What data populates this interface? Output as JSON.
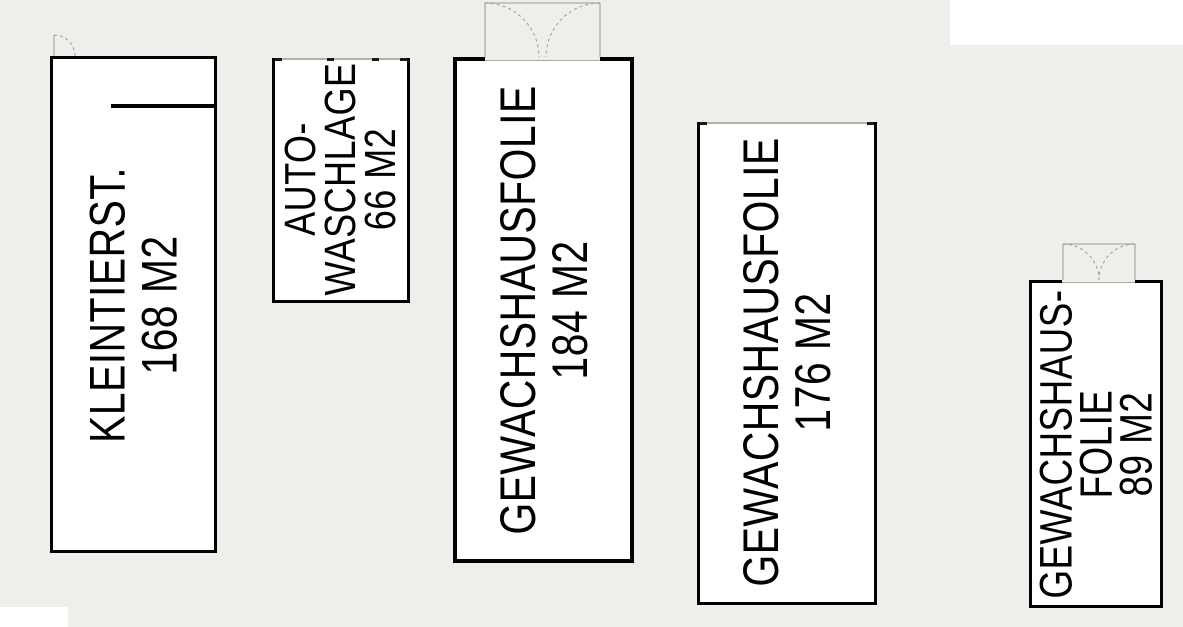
{
  "page": {
    "background_color": "#efeeea",
    "paper_color": "#ffffff",
    "wall_color": "#000000",
    "door_symbol_color": "#9b9a92"
  },
  "icons": {
    "single_door": "door-swing-icon",
    "double_door": "double-door-swing-icon"
  },
  "buildings": [
    {
      "id": "kleintierstall",
      "label_lines": [
        "KLEINTIERST.",
        "168 M2"
      ],
      "area_m2": 168
    },
    {
      "id": "autowaschanlage",
      "label_lines": [
        "AUTO-",
        "WASCHLAGE",
        "66 M2"
      ],
      "area_m2": 66
    },
    {
      "id": "gewaechshausfolie-1",
      "label_lines": [
        "GEWACHSHAUSFOLIE",
        "184 M2"
      ],
      "area_m2": 184
    },
    {
      "id": "gewaechshausfolie-2",
      "label_lines": [
        "GEWACHSHAUSFOLIE",
        "176 M2"
      ],
      "area_m2": 176
    },
    {
      "id": "gewaechshausfolie-3",
      "label_lines": [
        "GEWACHSHAUS-",
        "FOLIE",
        "89 M2"
      ],
      "area_m2": 89
    }
  ]
}
